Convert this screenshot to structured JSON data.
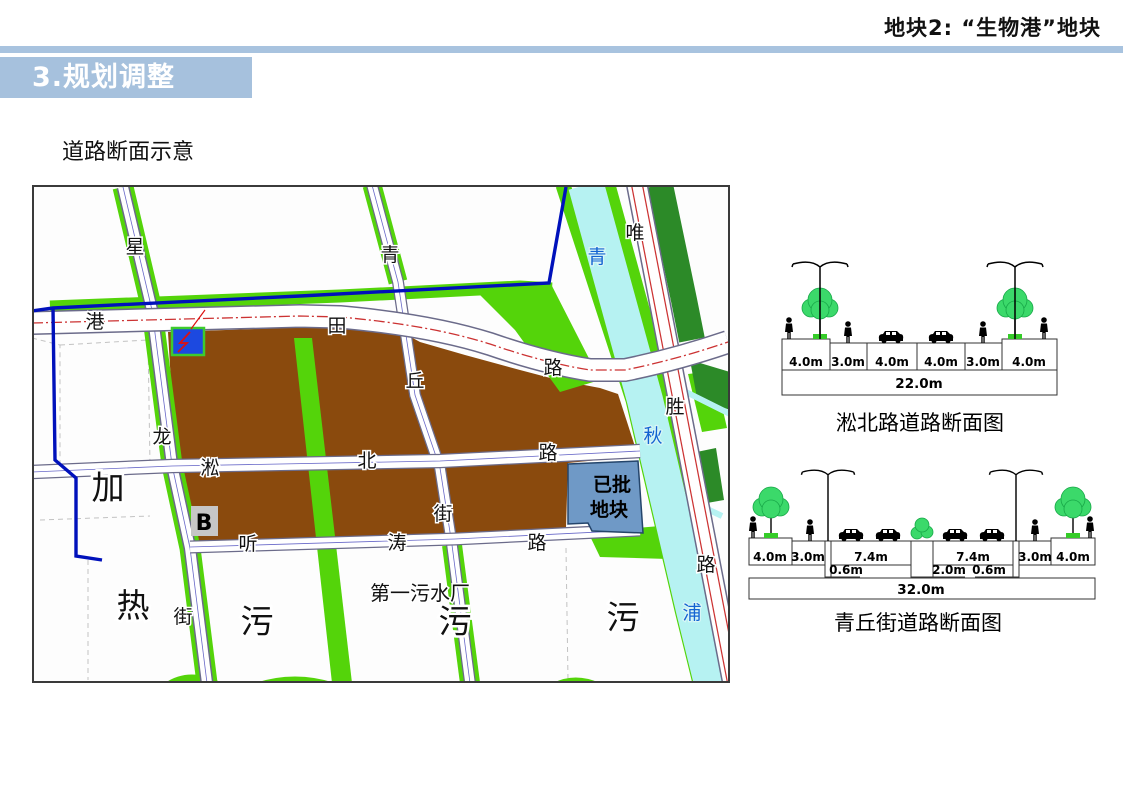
{
  "header": {
    "plot_title": "地块2: “生物港”地块"
  },
  "banner": {
    "title": "3.规划调整"
  },
  "subtitle": "道路断面示意",
  "colors": {
    "banner_blue": "#a6c1dd",
    "map_bright_green": "#54d40a",
    "map_dark_green": "#2c8a28",
    "river_cyan": "#b6f2f2",
    "plot_brown": "#8a4a0d",
    "approved_plot_blue": "#6f99c6",
    "substation_blue": "#1c49e0",
    "boundary_blue": "#0011bb",
    "road_red_line": "#cc3333"
  },
  "map": {
    "road_chars": [
      "星",
      "港",
      "田",
      "路",
      "青",
      "丘",
      "街",
      "淞",
      "北",
      "路",
      "听",
      "涛",
      "路",
      "龙",
      "街",
      "唯",
      "胜",
      "路"
    ],
    "river_chars": [
      "青",
      "秋",
      "浦"
    ],
    "area_labels": [
      "加",
      "热",
      "污",
      "污",
      "污"
    ],
    "facility_label": "第一污水厂",
    "approved_plot": [
      "已批",
      "地块"
    ],
    "marker_b": "B"
  },
  "sections": [
    {
      "caption": "淞北路道路断面图",
      "dims": [
        "4.0m",
        "3.0m",
        "4.0m",
        "4.0m",
        "3.0m",
        "4.0m"
      ],
      "total": "22.0m"
    },
    {
      "caption": "青丘街道路断面图",
      "dims_row1": [
        "4.0m",
        "3.0m",
        "7.4m",
        "7.4m",
        "3.0m",
        "4.0m"
      ],
      "dims_row2": [
        "0.6m",
        "2.0m",
        "0.6m"
      ],
      "total": "32.0m"
    }
  ]
}
